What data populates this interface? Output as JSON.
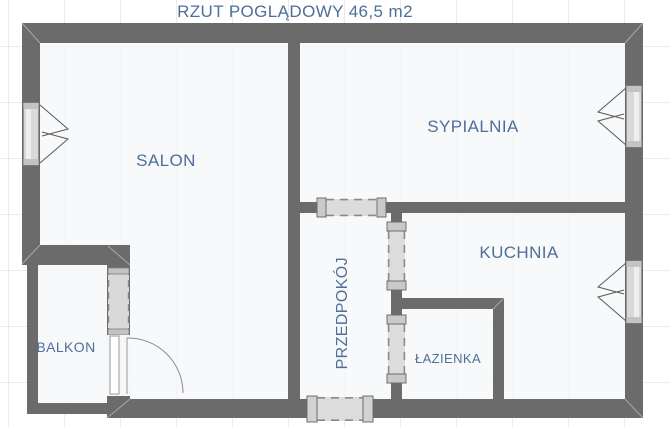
{
  "title": "RZUT POGLĄDOWY 46,5 m2",
  "rooms": {
    "salon": "SALON",
    "sypialnia": "SYPIALNIA",
    "kuchnia": "KUCHNIA",
    "przedpokoj": "PRZEDPOKÓJ",
    "lazienka": "ŁAZIENKA",
    "balkon": "BALKON"
  },
  "theme": {
    "wall": "#6b6b6b",
    "window_fill": "#d9d9d9",
    "window_cap": "#c3c3c3",
    "door_fill": "#dcdcdc",
    "label": "#4e6f99",
    "floor": "#f6f7f9",
    "grid": "#ebebeb",
    "bg": "#ffffff"
  }
}
